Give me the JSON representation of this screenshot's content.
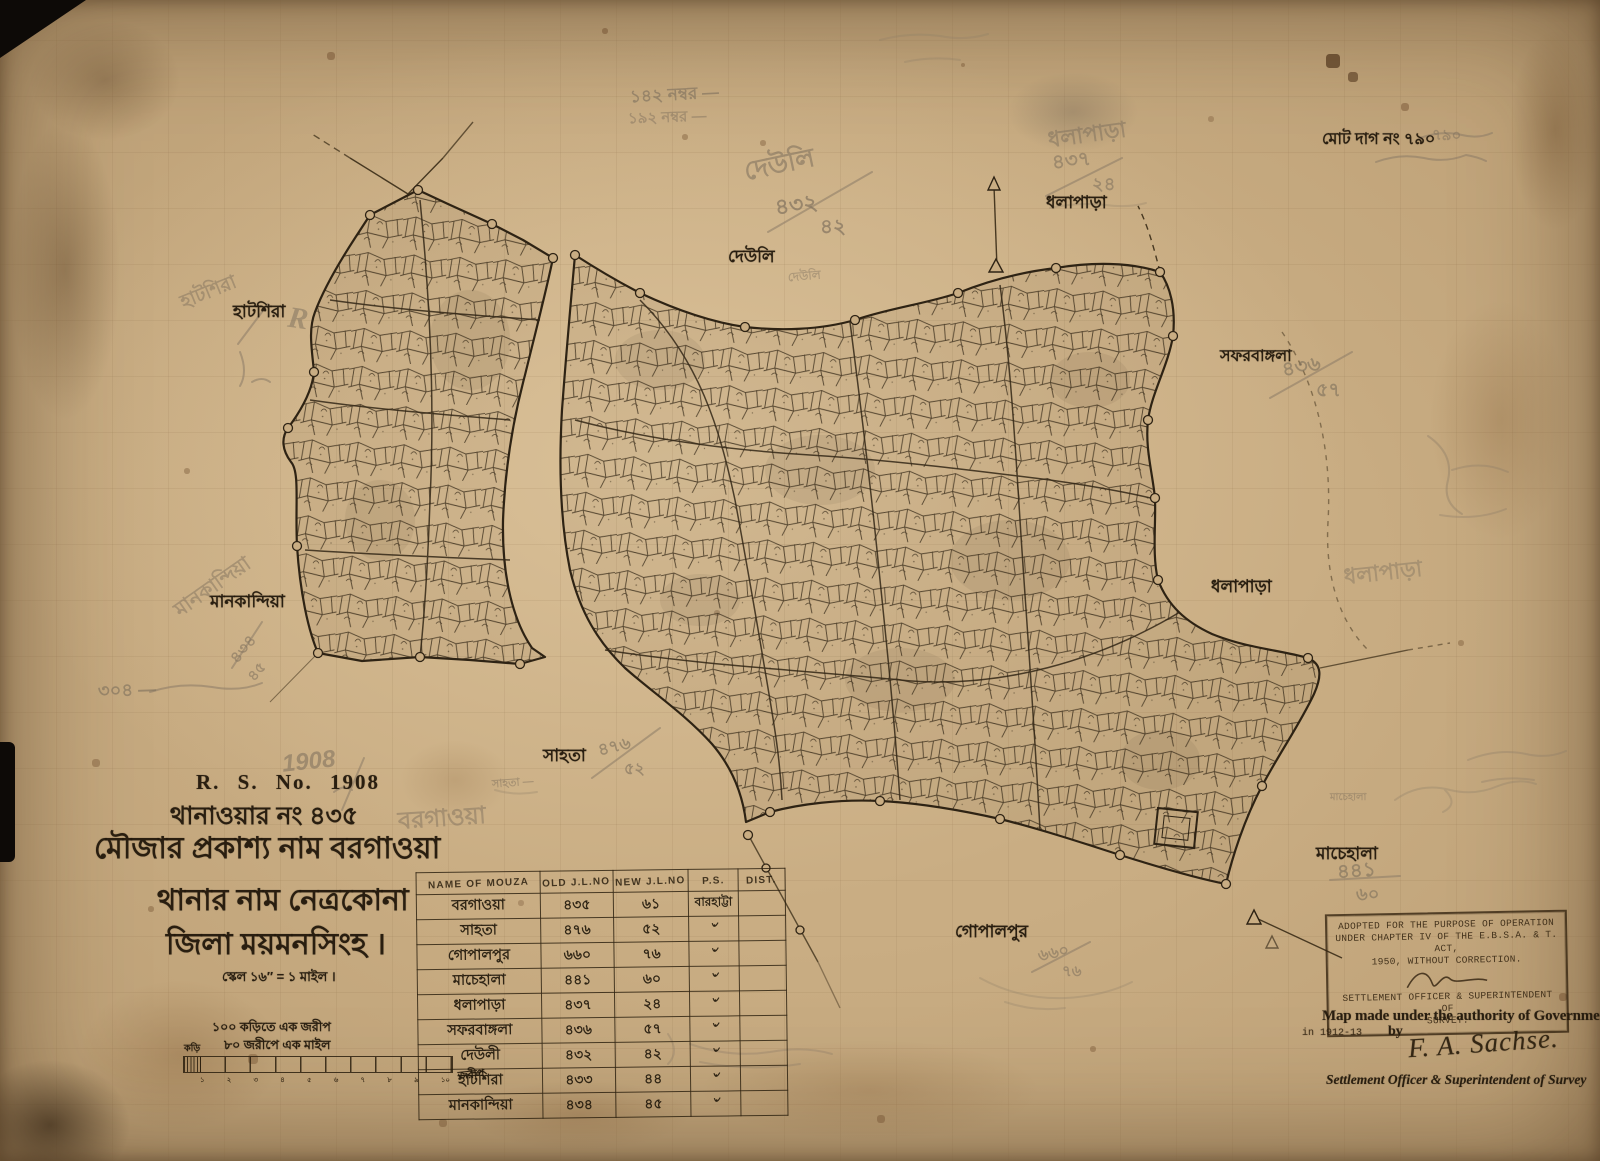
{
  "colors": {
    "paper": "#c9ad83",
    "ink": "#2f2314",
    "pencil": "#82735f",
    "stain": "#6b4a2a"
  },
  "title_block": {
    "rs_no": "R. S. No. 1908",
    "thana_no_line": "থানাওয়ার নং ৪৩৫",
    "mouza_name_line": "মৌজার প্রকাশ্য নাম বরগাওয়া",
    "thana_name_line": "থানার নাম নেত্রকোনা",
    "district_line": "জিলা ময়মনসিংহ ।",
    "scale_line": "স্কেল ১৬″ = ১ মাইল ।"
  },
  "scale_bar": {
    "note1": "১০০ কড়িতে এক জরীপ",
    "note2": "৮০ জরীপে এক মাইল",
    "left_label": "কড়ি",
    "right_label": "জরীপ",
    "ticks": [
      "১",
      "২",
      "৩",
      "৪",
      "৫",
      "৬",
      "৭",
      "৮",
      "৯",
      "১০"
    ]
  },
  "notes": {
    "total_plots": "মোট দাগ নং ৭৯০"
  },
  "place_labels": {
    "hatshira": "হাটশিরা",
    "deuli": "দেউলি",
    "dhalapara_top": "ধলাপাড়া",
    "safarbangla": "সফরবাঙ্গলা",
    "dhalapara_right": "ধলাপাড়া",
    "mankandia": "মানকান্দিয়া",
    "sahata": "সাহতা",
    "gopalpur": "গোপালপুর",
    "machehala": "মাচেহালা"
  },
  "pencil_notes": {
    "year": "1908",
    "borgaowa": "বরগাওয়া",
    "plot_142": "১৪২ নম্বর —",
    "plot_192": "১৯২ নম্বর —",
    "total_790": "৭৯০",
    "deuli": "দেউলি",
    "deuli_faint": "দেউলি",
    "deuli_frac_old": "৪৩২",
    "deuli_frac_new": "৪২",
    "dhalapara": "ধলাপাড়া",
    "dhalapara_frac_old": "৪৩৭",
    "dhalapara_frac_new": "২৪",
    "dhalapara_right": "ধলাপাড়া",
    "safar_frac_old": "৪৩৬",
    "safar_frac_new": "৫৭",
    "sahata_small": "সাহতা —",
    "sahata_frac_old": "৪৭৬",
    "sahata_frac_new": "৫২",
    "gopal_frac_old": "৬৬০",
    "gopal_frac_new": "৭৬",
    "machehala_small": "মাচেহালা",
    "machehala_frac_old": "৪৪১",
    "machehala_frac_new": "৬০",
    "mankandia": "মানকান্দিয়া",
    "mankandia_frac_old": "৪৩৪",
    "mankandia_frac_new": "৪৫",
    "hatshira": "হাটশিরা",
    "r_mark": "R",
    "note_304": "৩০৪ —"
  },
  "stamp": {
    "line1": "ADOPTED FOR THE PURPOSE OF OPERATION",
    "line2": "UNDER CHAPTER IV OF THE E.B.S.A. & T. ACT,",
    "line3": "1950, WITHOUT CORRECTION.",
    "line4": "SETTLEMENT OFFICER & SUPERINTENDENT OF",
    "line5": "SURVEY."
  },
  "authority": {
    "line1": "Map made under the authority of Government",
    "in_year": "in 1912-13",
    "by": "by",
    "signature": "F. A. Sachse.",
    "line2": "Settlement Officer & Superintendent of Survey"
  },
  "table": {
    "headers": [
      "NAME OF MOUZA",
      "OLD J.L.NO",
      "NEW J.L.NO",
      "P.S.",
      "DIST."
    ],
    "rows": [
      {
        "name": "বরগাওয়া",
        "old": "৪৩৫",
        "new": "৬১",
        "ps": "বারহাট্টা",
        "dist": ""
      },
      {
        "name": "সাহতা",
        "old": "৪৭৬",
        "new": "৫২",
        "ps": "৺",
        "dist": ""
      },
      {
        "name": "গোপালপুর",
        "old": "৬৬০",
        "new": "৭৬",
        "ps": "৺",
        "dist": ""
      },
      {
        "name": "মাচেহালা",
        "old": "৪৪১",
        "new": "৬০",
        "ps": "৺",
        "dist": ""
      },
      {
        "name": "ধলাপাড়া",
        "old": "৪৩৭",
        "new": "২৪",
        "ps": "৺",
        "dist": ""
      },
      {
        "name": "সফরবাঙ্গলা",
        "old": "৪৩৬",
        "new": "৫৭",
        "ps": "৺",
        "dist": ""
      },
      {
        "name": "দেউলী",
        "old": "৪৩২",
        "new": "৪২",
        "ps": "৺",
        "dist": ""
      },
      {
        "name": "হাটশিরা",
        "old": "৪৩৩",
        "new": "৪৪",
        "ps": "৺",
        "dist": ""
      },
      {
        "name": "মানকান্দিয়া",
        "old": "৪৩৪",
        "new": "৪৫",
        "ps": "৺",
        "dist": ""
      }
    ]
  }
}
